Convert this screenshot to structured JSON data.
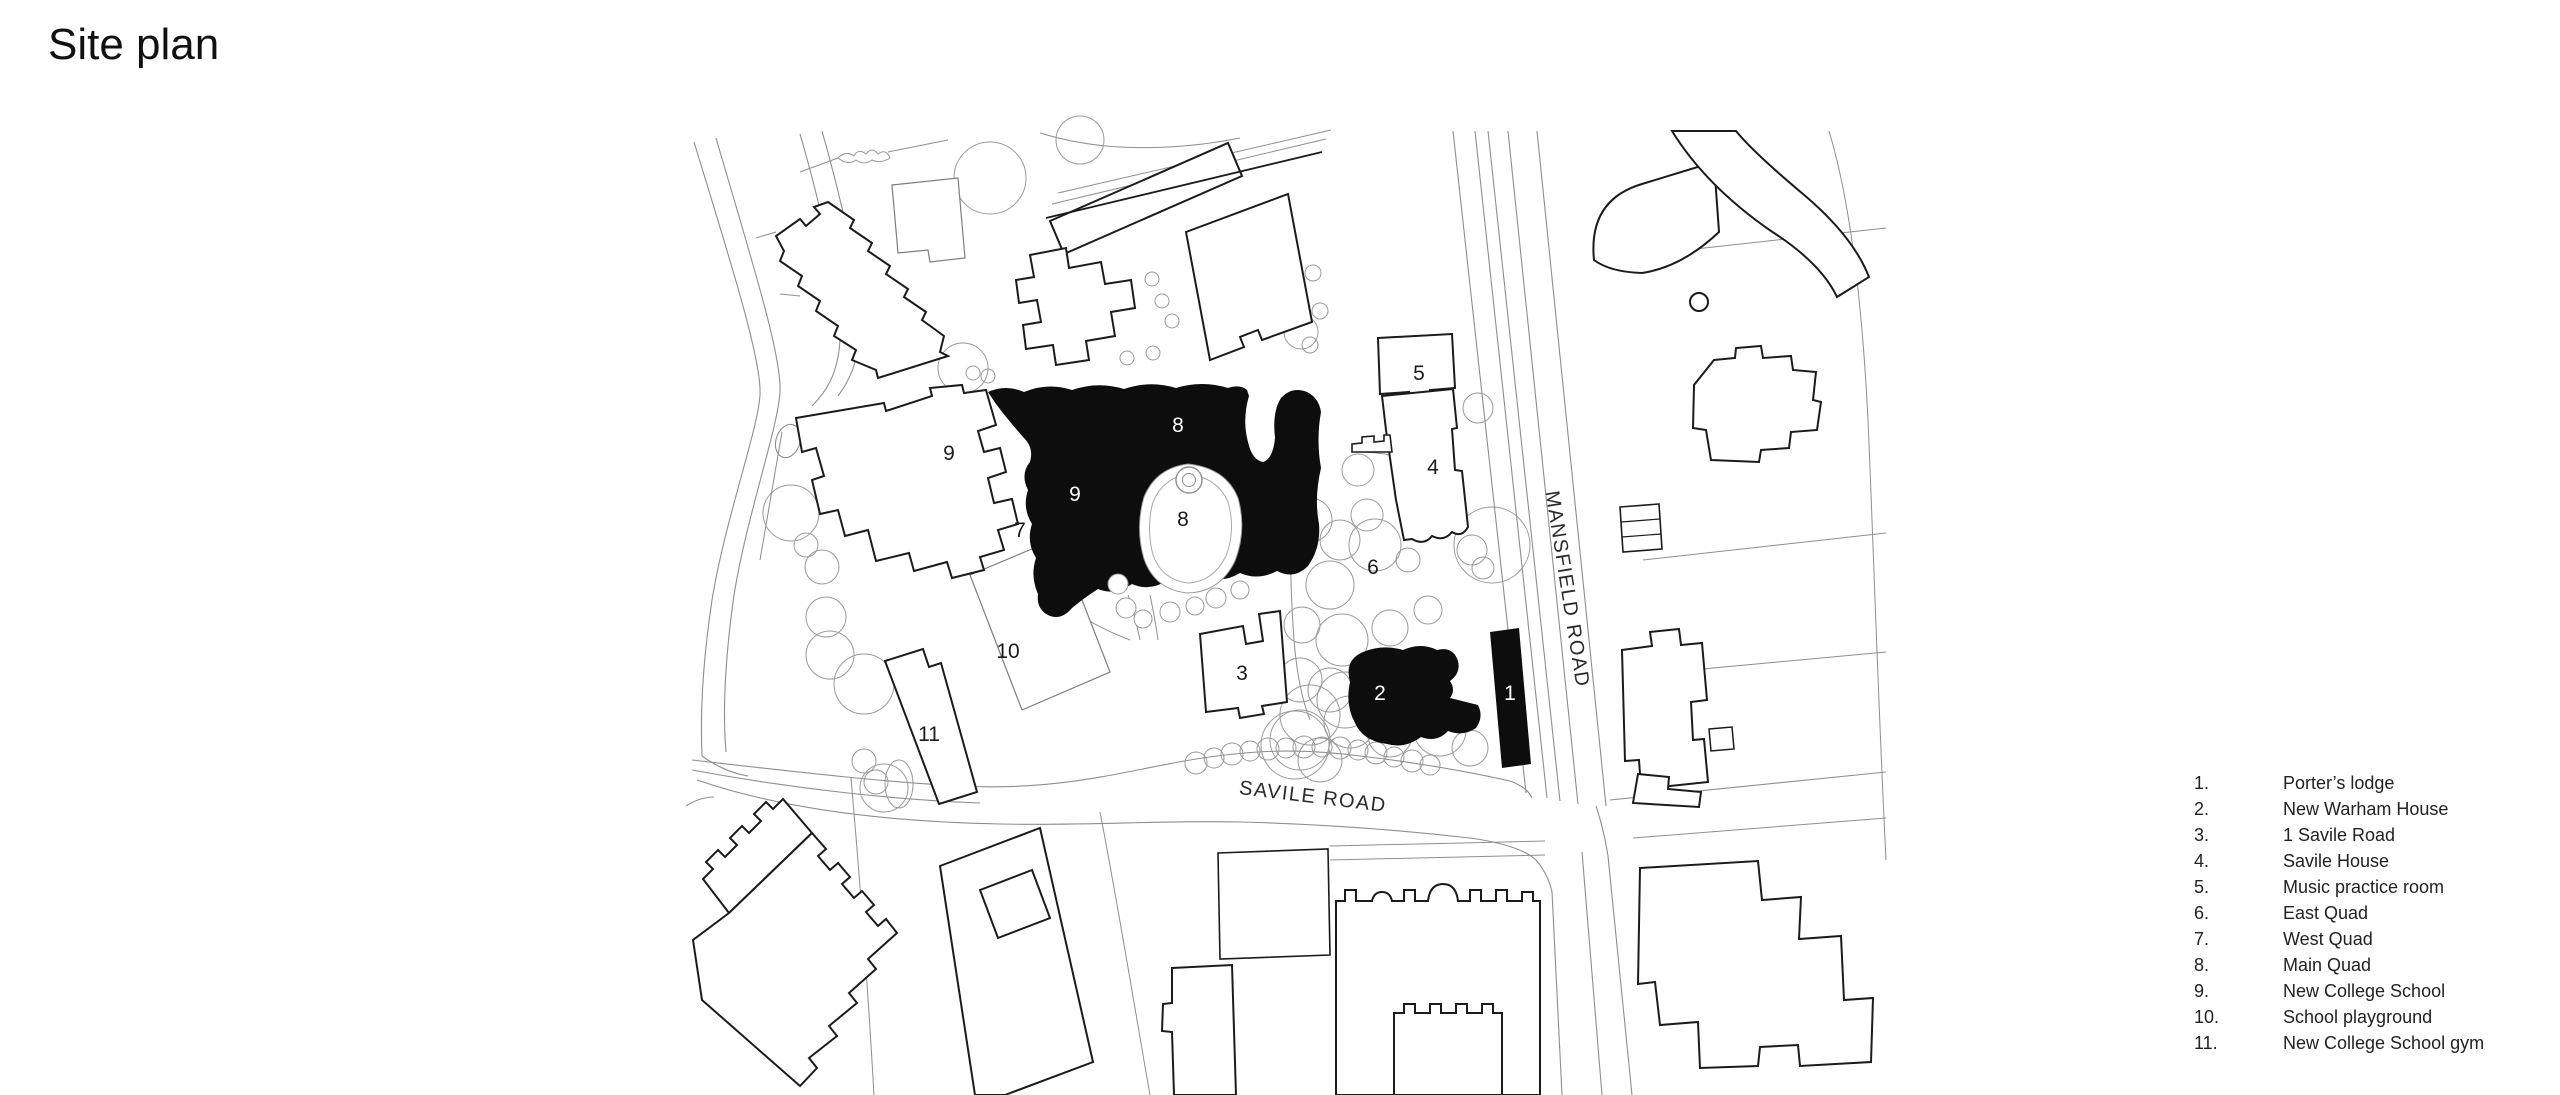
{
  "title": "Site plan",
  "colors": {
    "ink": "#1b1b1b",
    "building_fill_black": "#0d0d0d",
    "line_light": "#8e8e8e",
    "background": "#ffffff"
  },
  "map": {
    "road_labels": [
      {
        "text": "MANSFIELD ROAD"
      },
      {
        "text": "SAVILE ROAD"
      }
    ],
    "labels": [
      {
        "text": "9",
        "color": "dark"
      },
      {
        "text": "9",
        "color": "white"
      },
      {
        "text": "7",
        "color": "dark"
      },
      {
        "text": "8",
        "color": "white"
      },
      {
        "text": "8",
        "color": "dark"
      },
      {
        "text": "10",
        "color": "dark"
      },
      {
        "text": "11",
        "color": "dark"
      },
      {
        "text": "3",
        "color": "dark"
      },
      {
        "text": "2",
        "color": "white"
      },
      {
        "text": "1",
        "color": "white"
      },
      {
        "text": "6",
        "color": "dark"
      },
      {
        "text": "4",
        "color": "dark"
      },
      {
        "text": "5",
        "color": "dark"
      }
    ]
  },
  "legend": {
    "items": [
      {
        "num": "1.",
        "label": "Porter’s lodge"
      },
      {
        "num": "2.",
        "label": "New Warham House"
      },
      {
        "num": "3.",
        "label": "1 Savile Road"
      },
      {
        "num": "4.",
        "label": "Savile House"
      },
      {
        "num": "5.",
        "label": "Music practice room"
      },
      {
        "num": "6.",
        "label": "East Quad"
      },
      {
        "num": "7.",
        "label": "West Quad"
      },
      {
        "num": "8.",
        "label": "Main Quad"
      },
      {
        "num": "9.",
        "label": "New College School"
      },
      {
        "num": "10.",
        "label": "School playground"
      },
      {
        "num": "11.",
        "label": "New College School gym"
      }
    ]
  }
}
